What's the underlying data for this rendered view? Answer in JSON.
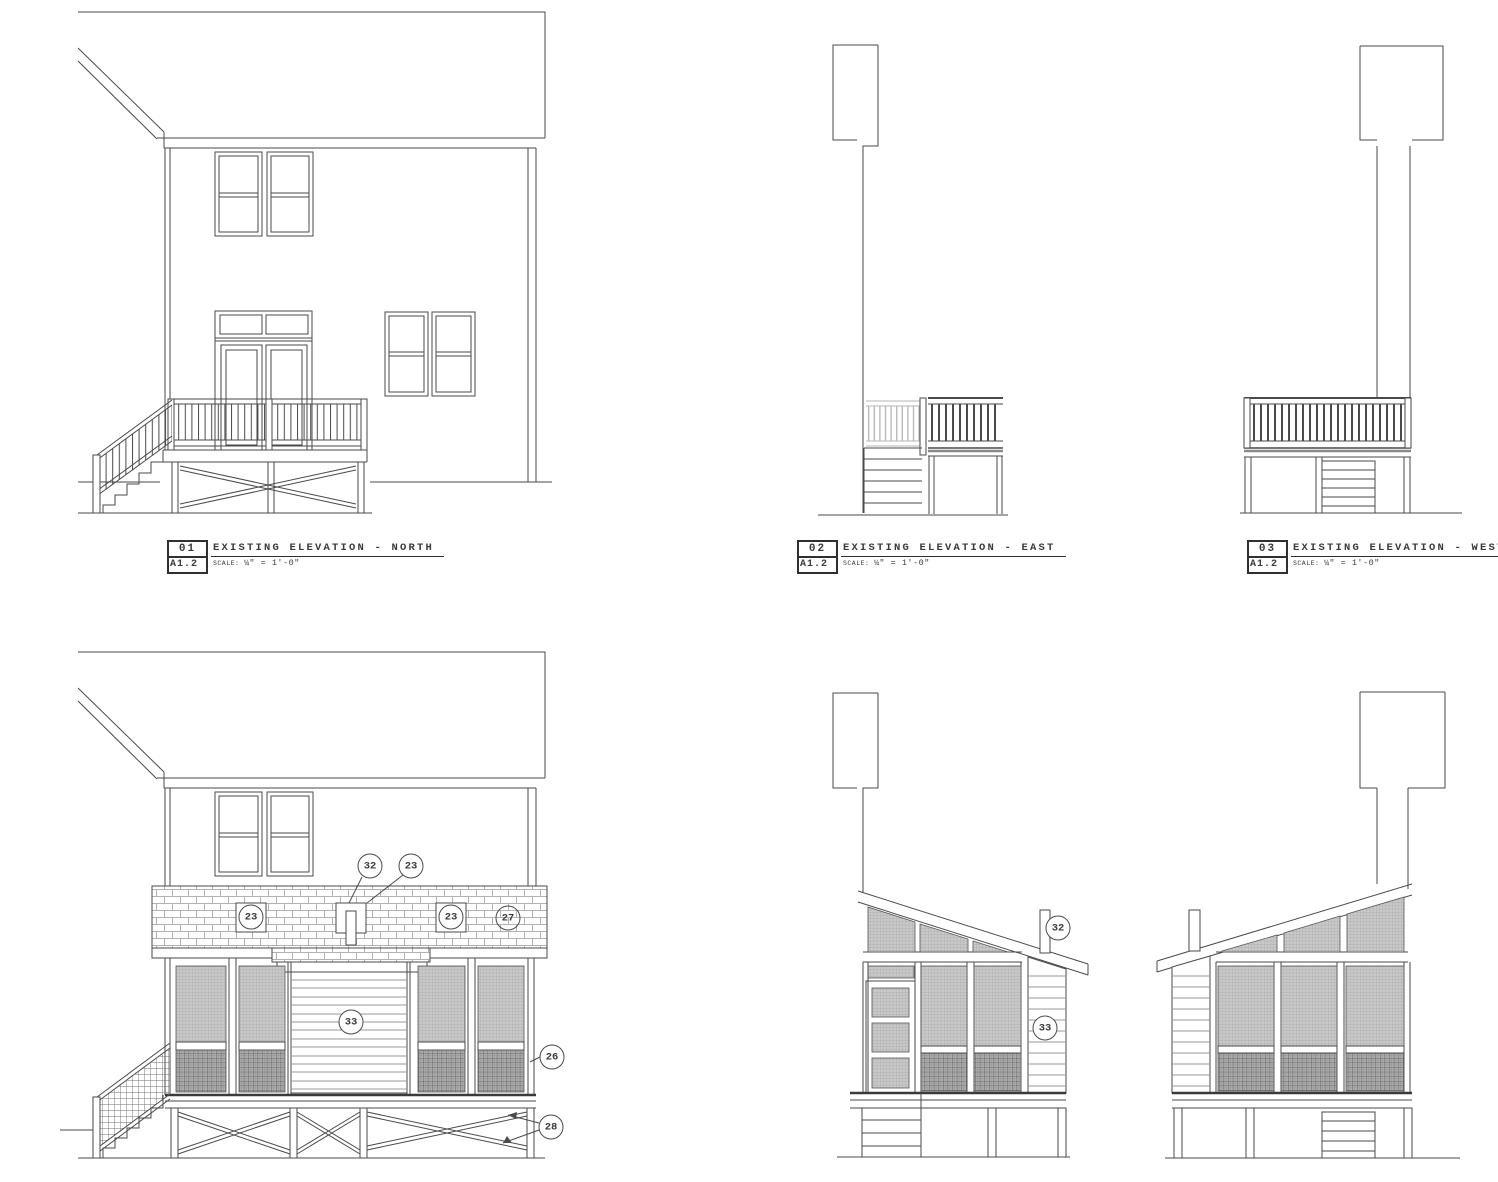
{
  "sheet": {
    "background": "#ffffff",
    "line_color": "#4a4a4a"
  },
  "title_blocks": [
    {
      "number": "01",
      "sheet_ref": "A1.2",
      "title": "EXISTING ELEVATION - NORTH",
      "scale_label": "SCALE:",
      "scale_value": "¼\" = 1'-0\""
    },
    {
      "number": "02",
      "sheet_ref": "A1.2",
      "title": "EXISTING ELEVATION - EAST",
      "scale_label": "SCALE:",
      "scale_value": "¼\" = 1'-0\""
    },
    {
      "number": "03",
      "sheet_ref": "A1.2",
      "title": "EXISTING ELEVATION - WEST",
      "scale_label": "SCALE:",
      "scale_value": "¼\" = 1'-0\""
    }
  ],
  "callouts": {
    "proposed_north": {
      "roof_vent": "32",
      "shingle_note": "23",
      "vent_left": "23",
      "vent_right": "23",
      "band_tag": "27",
      "center_wall": "33",
      "screen_base": "26",
      "cross_bracing": "28"
    },
    "proposed_east": {
      "roof_vent": "32",
      "corner_wall": "33"
    }
  }
}
